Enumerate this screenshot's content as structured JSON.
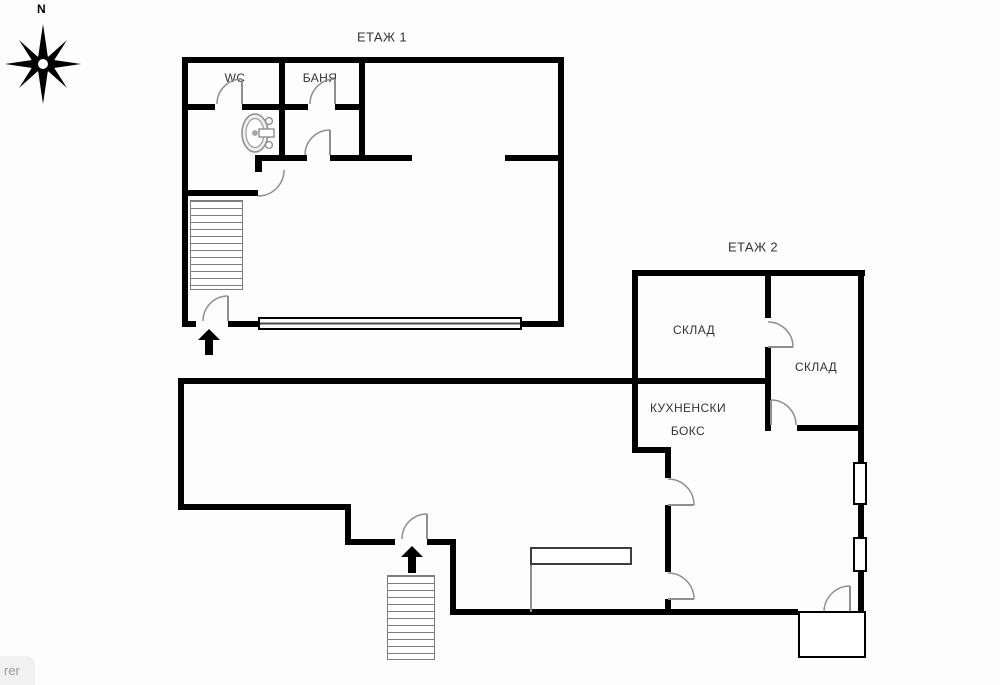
{
  "compass": {
    "north_label": "N"
  },
  "floor1": {
    "title": "ЕТАЖ 1",
    "wc_label": "WC",
    "bath_label": "БАНЯ"
  },
  "floor2": {
    "title": "ЕТАЖ 2",
    "storage1_label": "СКЛАД",
    "storage2_label": "СКЛАД",
    "kitchen_label_line1": "КУХНЕНСКИ",
    "kitchen_label_line2": "БОКС",
    "bar_label": "БАР",
    "wc_label": "WC"
  },
  "status_tooltip": {
    "text": "rer"
  },
  "colors": {
    "wall": "#000000",
    "fixture": "#8f8f8f",
    "label_text": "#333333",
    "background": "#fdfdfd"
  }
}
